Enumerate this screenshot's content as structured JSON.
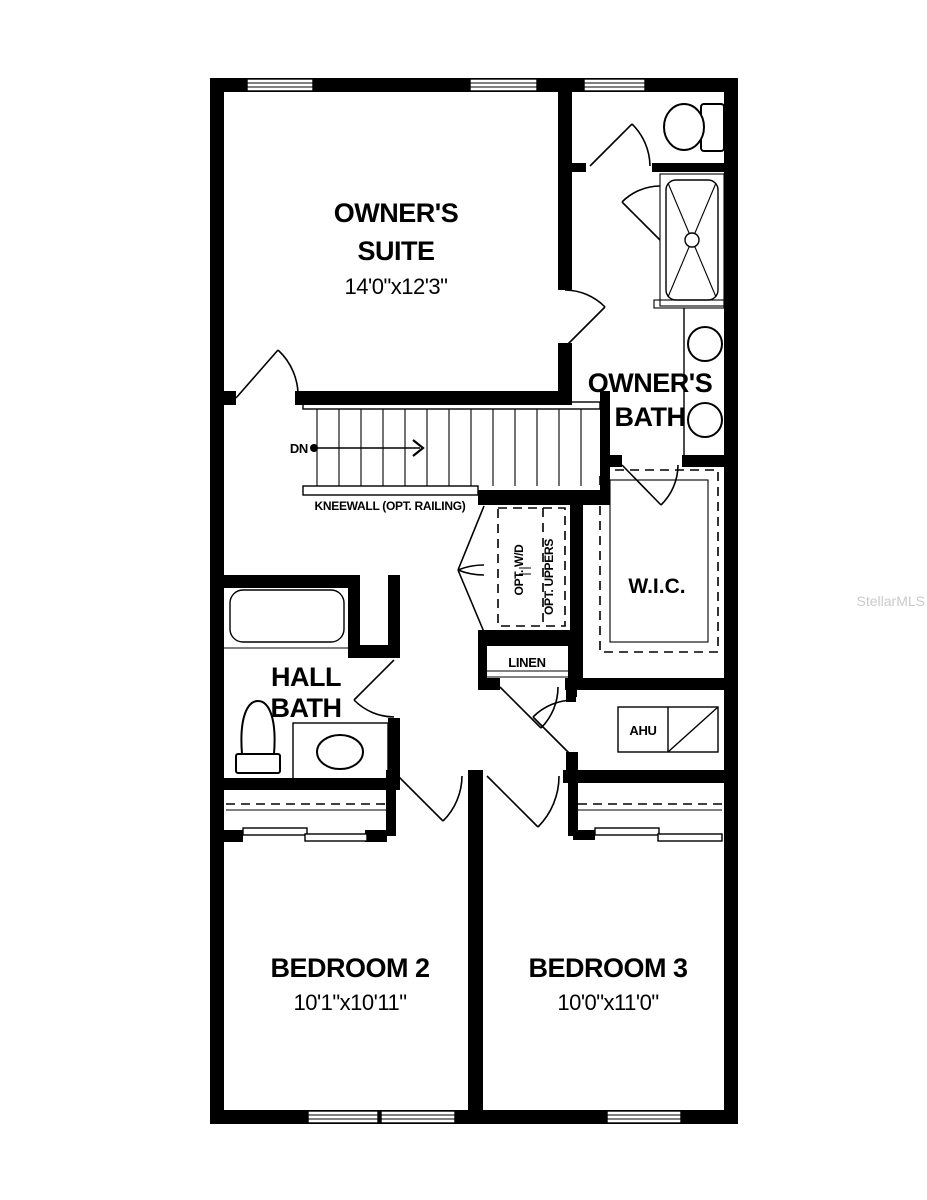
{
  "plan": {
    "floor_type": "floor-plan",
    "rooms": {
      "owners_suite": {
        "name_line1": "OWNER'S",
        "name_line2": "SUITE",
        "dims": "14'0\"x12'3\""
      },
      "owners_bath": {
        "name_line1": "OWNER'S",
        "name_line2": "BATH"
      },
      "wic": {
        "name": "W.I.C."
      },
      "hall_bath": {
        "name_line1": "HALL",
        "name_line2": "BATH"
      },
      "bedroom2": {
        "name": "BEDROOM 2",
        "dims": "10'1\"x10'11\""
      },
      "bedroom3": {
        "name": "BEDROOM 3",
        "dims": "10'0\"x11'0\""
      },
      "linen": {
        "name": "LINEN"
      },
      "ahu": {
        "name": "AHU"
      },
      "laundry": {
        "opt_wd": "OPT. W/D",
        "opt_uppers": "OPT. UPPERS"
      }
    },
    "stairs": {
      "direction_label": "DN",
      "kneewall_label": "KNEEWALL (OPT. RAILING)"
    },
    "watermark": "StellarMLS"
  }
}
